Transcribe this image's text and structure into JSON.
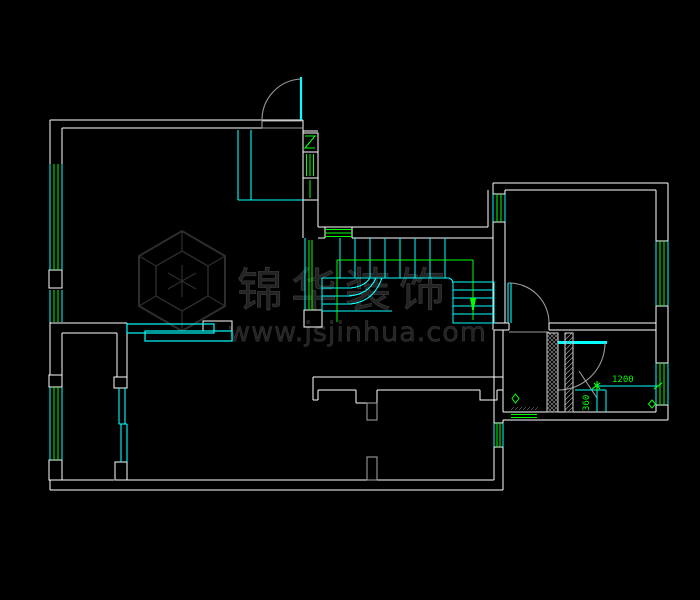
{
  "drawing": {
    "kind": "residential-floor-plan-cad",
    "background_color": "#000000",
    "wall_color": "#ffffff",
    "window_color": "#00ff00",
    "fixture_color": "#00ffff",
    "swing_color": "#9a9a9a"
  },
  "annotations": {
    "dim_horizontal": "1200",
    "dim_vertical": "360"
  },
  "watermark": {
    "brand": "锦华装饰",
    "url": "www.jsjinhua.com"
  },
  "symbols": [
    "entry-door-swing",
    "bedroom-door-swing",
    "utility-door-swing",
    "sliding-door",
    "staircase-u-shaped",
    "window-strips-green",
    "flue-z-symbol",
    "floor-drain-diamond",
    "hatched-masonry-wall"
  ]
}
